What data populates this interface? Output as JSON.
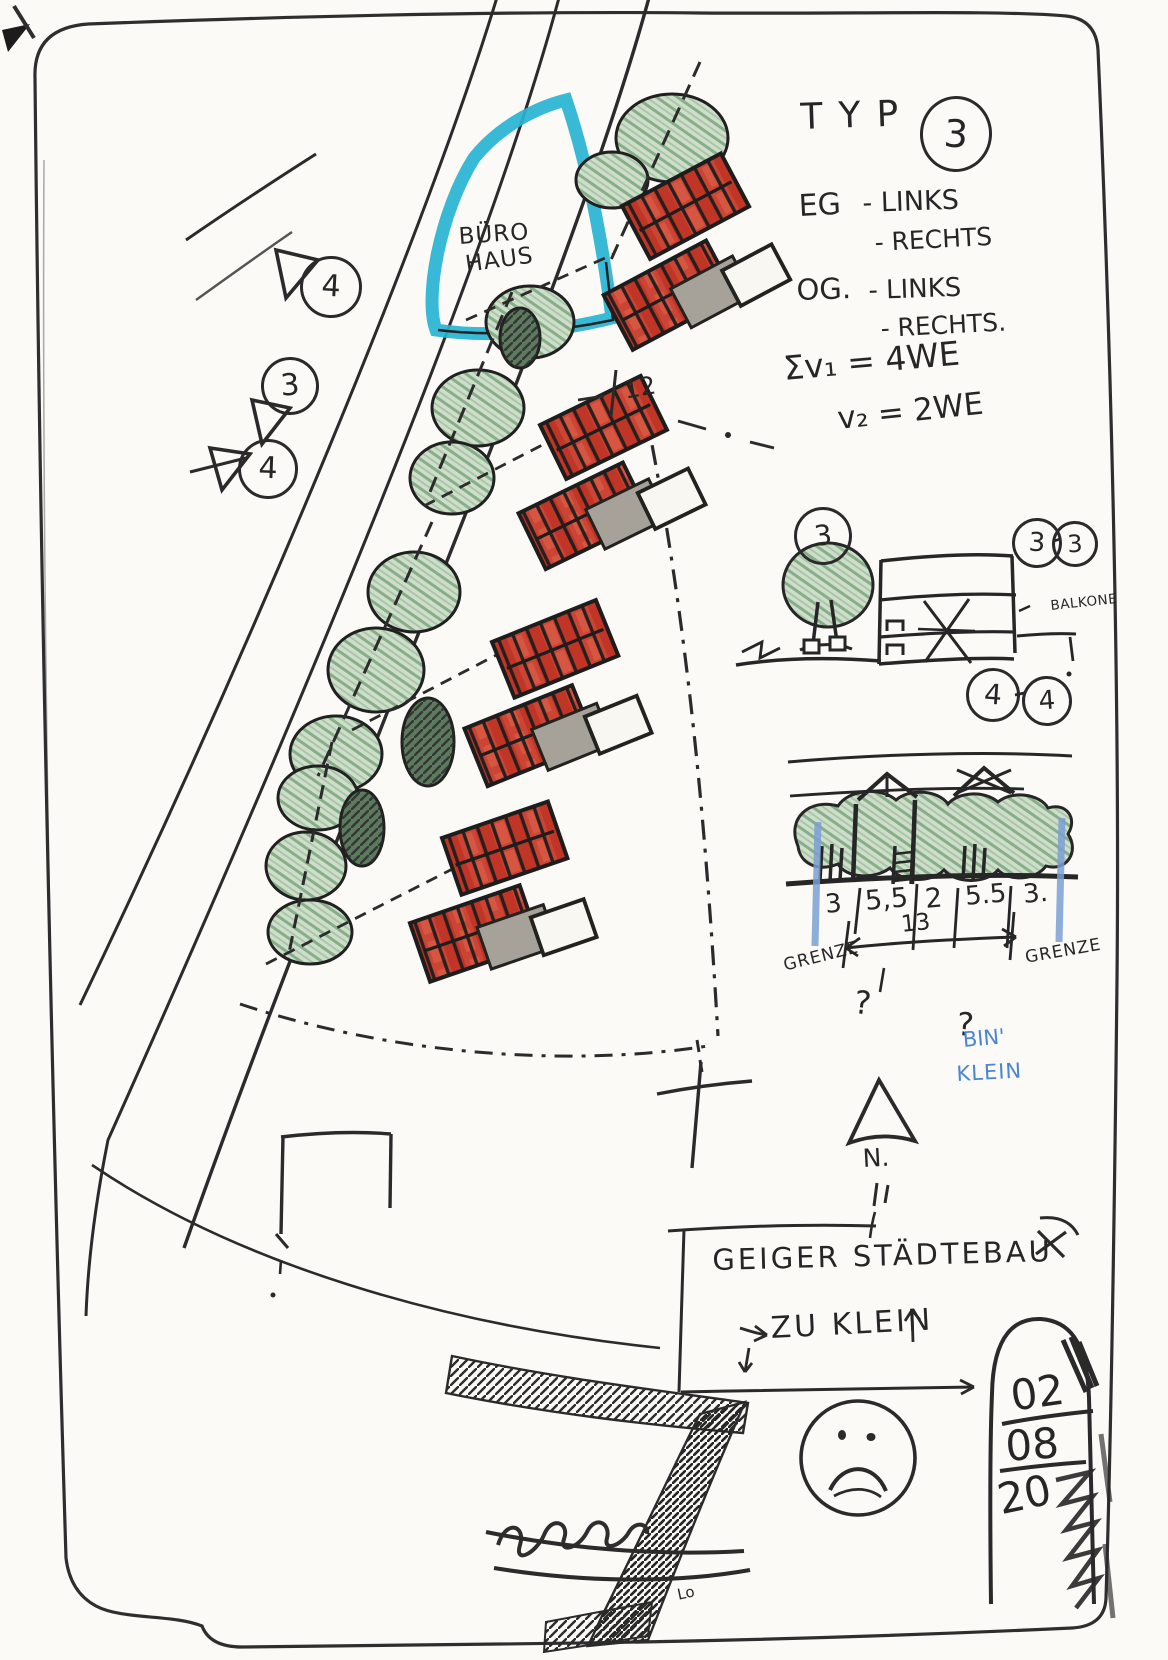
{
  "colors": {
    "ink": "#2a2a2a",
    "red_roof": "#cc4434",
    "red_dark": "#c03526",
    "tree_green": "#cfdecb",
    "tree_stroke": "#86ae88",
    "lake_cyan": "#27b4d4",
    "annex_gray": "#a6a199",
    "blue_ink": "#4d86cf",
    "boundary_blue": "#7b9fd4"
  },
  "legend": {
    "typ": "TYP",
    "typ_num": "3",
    "eg": "EG",
    "eg_1": "- LINKS",
    "eg_2": "- RECHTS",
    "og": "OG.",
    "og_1": "- LINKS",
    "og_2": "- RECHTS.",
    "sum1": "Σv₁ = 4WE",
    "sum2": "v₂ = 2WE"
  },
  "plan": {
    "buero1": "BÜRO",
    "buero2": "HAUS",
    "marker_top": "4",
    "marker_mid": "3",
    "marker_low": "4",
    "dim": "12"
  },
  "section1": {
    "tree_num": "3",
    "bub_l": "3",
    "bub_r": "3",
    "balkone": "BALKONE"
  },
  "section2": {
    "bub_l": "4",
    "bub_r": "4",
    "dims": [
      "3",
      "5,5",
      "2",
      "5.5",
      "3."
    ],
    "total": "13",
    "grenze_l": "GRENZE",
    "grenze_r": "GRENZE",
    "q1": "?",
    "q2": "?",
    "blue1": "BIN'",
    "blue2": "KLEIN"
  },
  "north": {
    "label": "N."
  },
  "note": {
    "line1": "GEIGER STÄDTEBAU",
    "line2": "ZU KLEIN"
  },
  "date": {
    "d1": "02",
    "d2": "08",
    "d3": "20"
  },
  "misc": {
    "lo": "Lo"
  }
}
